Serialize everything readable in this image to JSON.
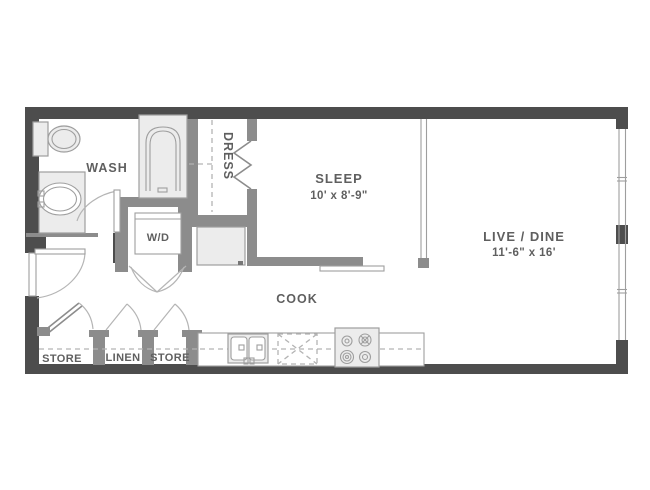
{
  "floorplan": {
    "rooms": {
      "wash": {
        "label": "WASH"
      },
      "dress": {
        "label": "DRESS"
      },
      "sleep": {
        "label": "SLEEP",
        "dimensions": "10' x 8'-9\""
      },
      "live_dine": {
        "label": "LIVE / DINE",
        "dimensions": "11'-6\" x 16'"
      },
      "cook": {
        "label": "COOK"
      },
      "store_left": {
        "label": "STORE"
      },
      "linen": {
        "label": "LINEN"
      },
      "store_right": {
        "label": "STORE"
      },
      "washer_dryer": {
        "label": "W/D"
      }
    },
    "colors": {
      "background": "#ffffff",
      "exterior_wall": "#4d4d4d",
      "interior_wall": "#8c8c8c",
      "fixture_fill": "#ececec",
      "fixture_outline": "#9e9e9e",
      "dashed_line": "#b3b3b3",
      "text": "#5f5f5f"
    }
  }
}
